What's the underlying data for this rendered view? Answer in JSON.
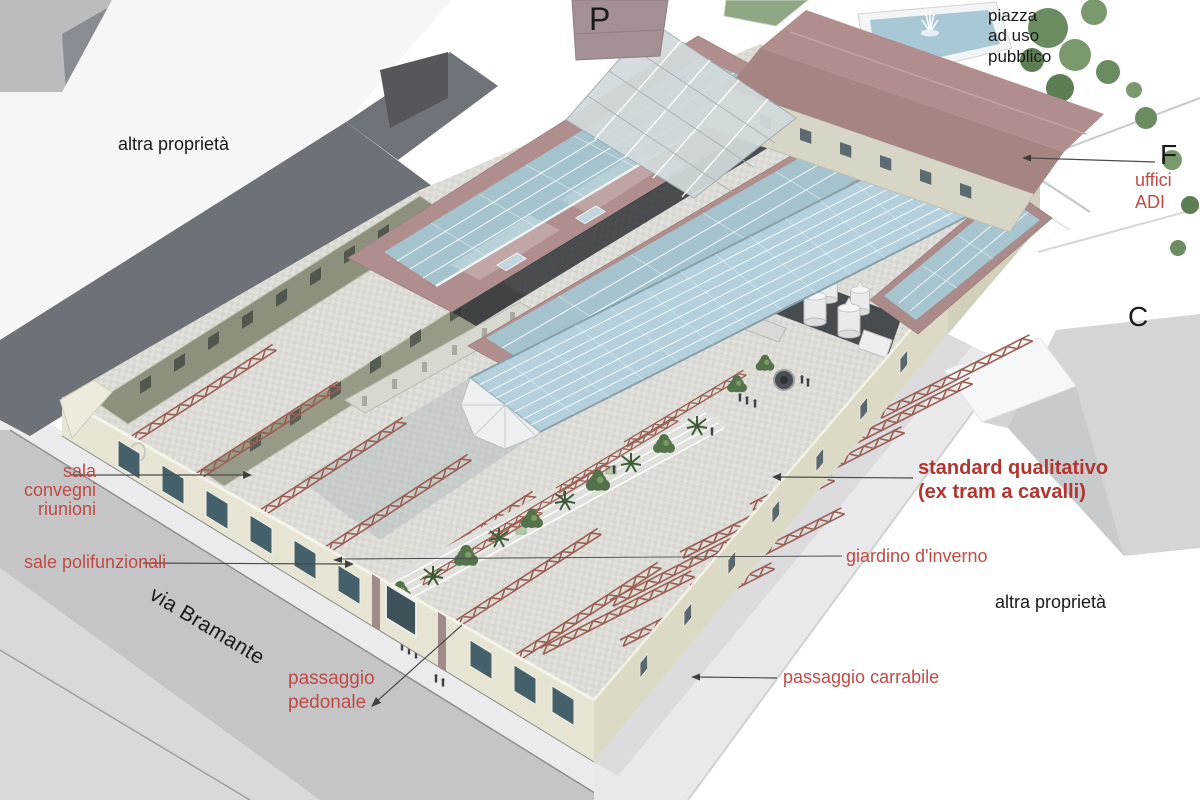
{
  "scene": {
    "description": "axonometric architectural rendering of ex tram depot redevelopment with annotated areas",
    "colors": {
      "annotation_red": "#c04a44",
      "annotation_red_bold": "#b23530",
      "annotation_black": "#1a1a1a",
      "roof_mauve": "#b08e8e",
      "glass_skylight": "#a4c3cd",
      "glass_vault": "#b3d0dc",
      "facade_cream": "#e7e4d4",
      "ruin_wall_olive": "#8d907c",
      "truss_red": "#9b5f54",
      "street_gray": "#c5c5c7",
      "dark_block_gray": "#6c7277",
      "tree_green": "#55734a",
      "pool_blue": "#a9c8d6"
    }
  },
  "labels": {
    "parking": {
      "text": "P"
    },
    "piazza": {
      "text": "piazza\nad uso\npubblico"
    },
    "altra_proprieta_left": {
      "text": "altra proprietà"
    },
    "f_marker": {
      "text": "F"
    },
    "uffici_adi": {
      "text": "uffici ADI"
    },
    "c_marker": {
      "text": "C"
    },
    "sala_convegni": {
      "text": "sala\nconvegni\nriunioni"
    },
    "sale_polifunzionali": {
      "text": "sale polifunzionali"
    },
    "via_bramante": {
      "text": "via Bramante"
    },
    "passaggio_pedonale": {
      "text": "passaggio\npedonale"
    },
    "standard_qualitativo": {
      "text": "standard qualitativo\n(ex tram a cavalli)"
    },
    "giardino_inverno": {
      "text": "giardino d'inverno"
    },
    "altra_proprieta_right": {
      "text": "altra proprietà"
    },
    "passaggio_carrabile": {
      "text": "passaggio carrabile"
    }
  }
}
